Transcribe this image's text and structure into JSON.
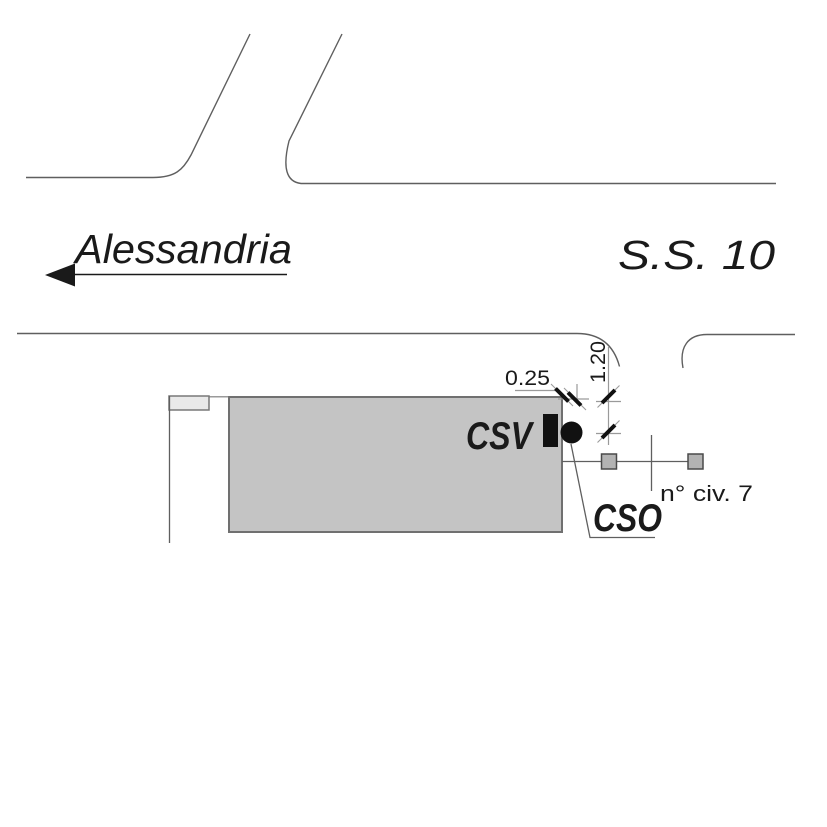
{
  "direction": {
    "label": "Alessandria"
  },
  "road": {
    "label": "S.S. 10"
  },
  "utilities": {
    "csv_label": "CSV",
    "cso_label": "CSO"
  },
  "dimensions": {
    "offset": "0.25",
    "depth": "1.20"
  },
  "civic": {
    "label": "n° civ. 7"
  },
  "colors": {
    "background": "#ffffff",
    "road_line": "#5f5f5f",
    "building_fill": "#c4c4c4",
    "building_stroke": "#707070",
    "annex_fill": "#e9e9e9",
    "marker_fill": "#b3b3b3",
    "marker_stroke": "#4a4a4a",
    "valve_fill": "#111111",
    "dim_line": "#9a9a9a",
    "ink": "#1a1a1a"
  }
}
